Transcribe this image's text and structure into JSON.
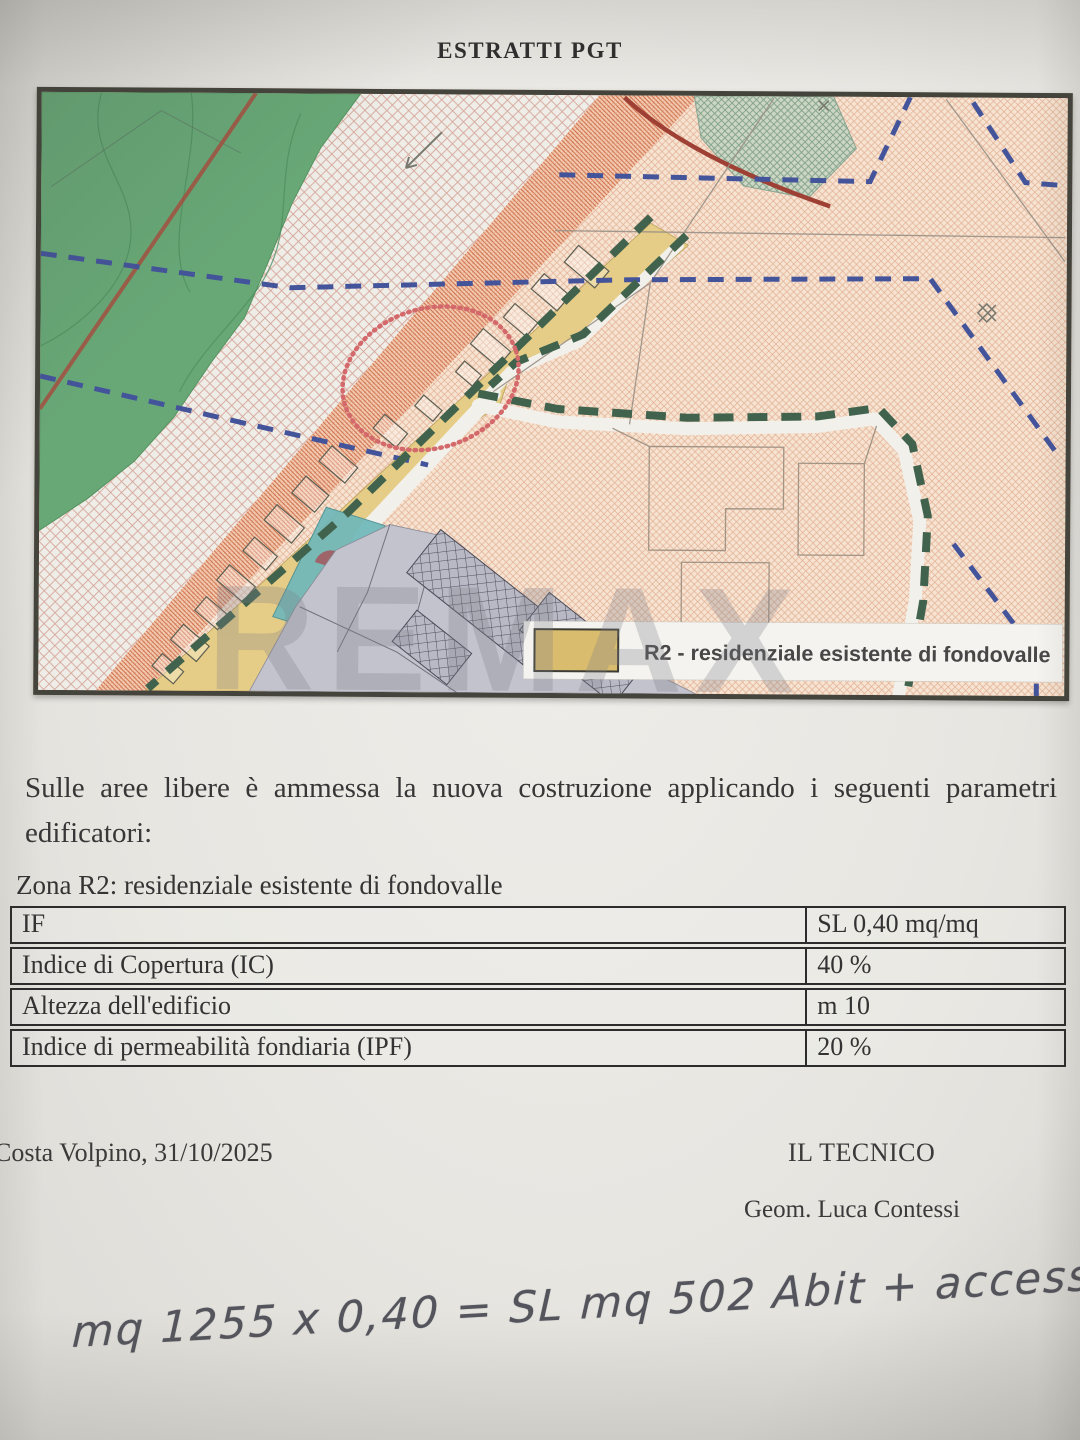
{
  "title": "ESTRATTI PGT",
  "intro": {
    "line1": "Sulle aree libere è ammessa la nuova costruzione applicando i seguenti parametri",
    "line2": "edificatori:"
  },
  "zone_heading": "Zona R2: residenziale esistente di fondovalle",
  "table": {
    "rows": [
      {
        "label": "IF",
        "value": "SL 0,40 mq/mq"
      },
      {
        "label": "Indice di Copertura (IC)",
        "value": "40 %"
      },
      {
        "label": "Altezza dell'edificio",
        "value": "m 10"
      },
      {
        "label": "Indice di permeabilità fondiaria (IPF)",
        "value": "20 %"
      }
    ]
  },
  "map": {
    "legend_label": "R2 - residenziale esistente di fondovalle",
    "legend_color": "#d9bc6e",
    "watermark": "REMAX"
  },
  "footer": {
    "place_date": "Costa Volpino, 31/10/2025",
    "role": "IL TECNICO",
    "name": "Geom. Luca Contessi"
  },
  "handwritten_note": "mq 1255 x 0,40 = SL mq 502  Abit + accessor",
  "colors": {
    "r2_swatch": "#d9bc6e",
    "map_green": "#68a877",
    "map_peach": "#f5e2cf",
    "dashed_blue": "#44549b",
    "dashed_green": "#41634d",
    "highlight_red": "#d4696b"
  }
}
